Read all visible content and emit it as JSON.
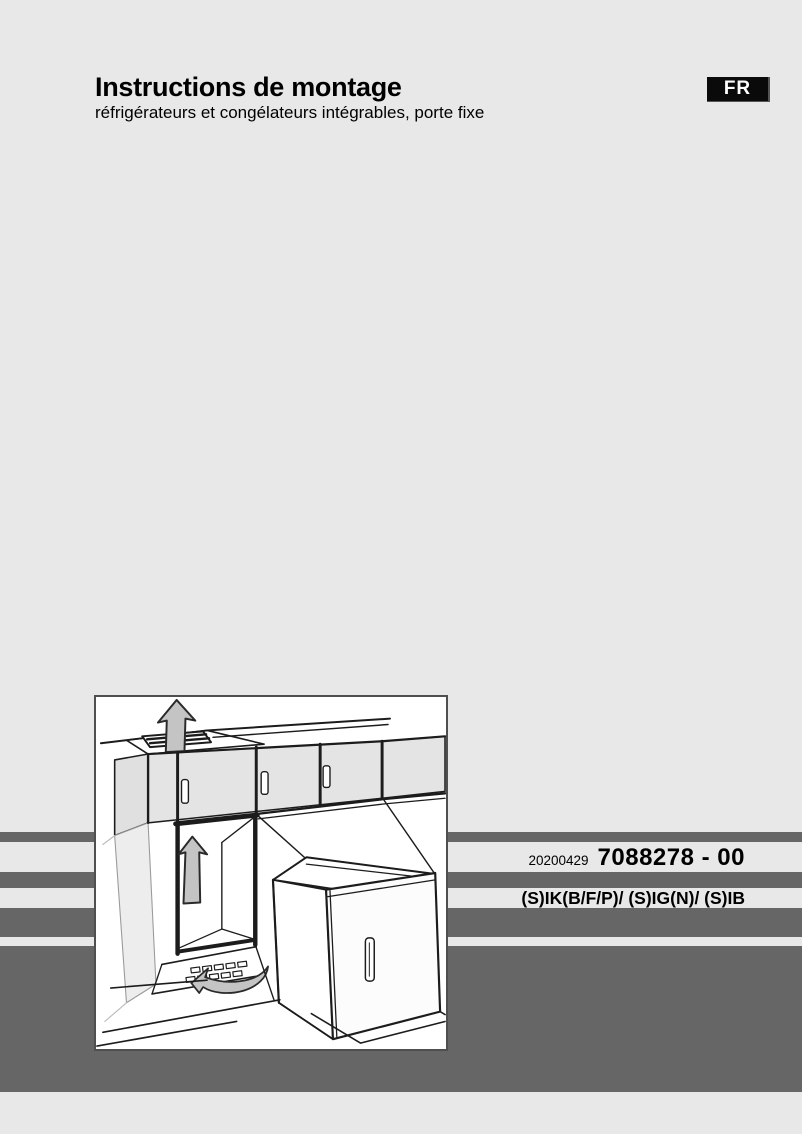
{
  "header": {
    "title": "Instructions de montage",
    "subtitle": "réfrigérateurs et congélateurs intégrables, porte fixe",
    "language_badge": "FR"
  },
  "edition": {
    "date": "20200429",
    "document_number": "7088278 - 00"
  },
  "models_line": "(S)IK(B/F/P)/ (S)IG(N)/ (S)IB",
  "brand": {
    "logo_text": "LIEBHERR"
  },
  "illustration": {
    "name": "built-in-fridge-installation-drawing",
    "elements": [
      "upper-cabinets-with-handles",
      "top-vent-grille",
      "airflow-up-arrow-top",
      "installation-niche",
      "airflow-up-arrow-niche",
      "plinth-vent-grille",
      "airflow-arrow-plinth",
      "appliance-with-open-door"
    ]
  },
  "colors": {
    "page_background": "#e8e8e8",
    "stripe_gray": "#666666",
    "badge_background": "#0a0a0a",
    "badge_text": "#ffffff",
    "logo_color": "#2b2b2b",
    "text_color": "#000000",
    "arrow_fill": "#c4c4c4",
    "cabinet_fill": "#e4e4e4"
  }
}
